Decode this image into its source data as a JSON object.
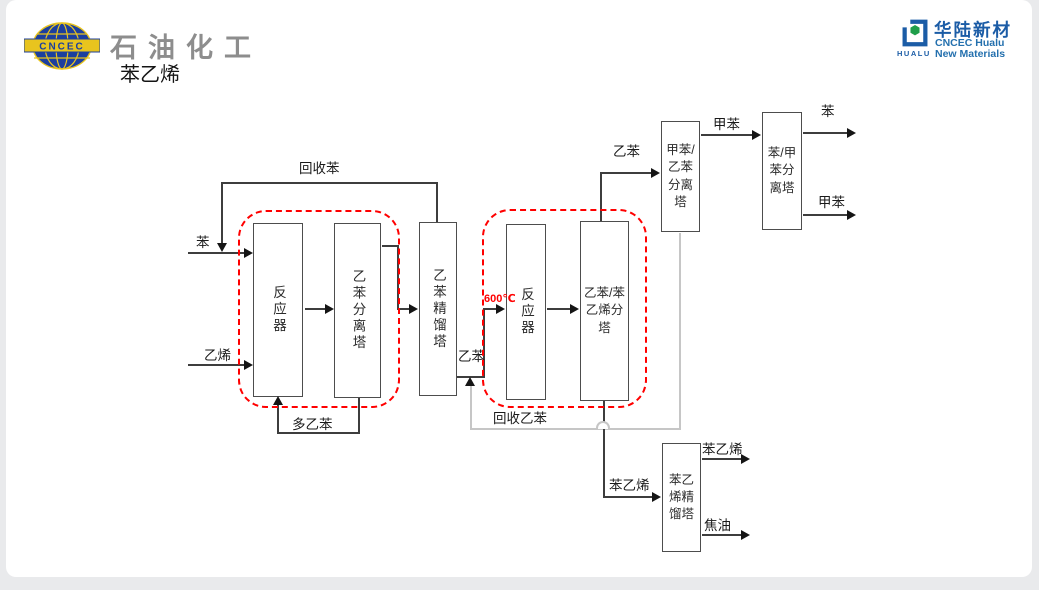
{
  "slide": {
    "brand_left": {
      "logo_text": "CNCEC",
      "dept_title": "石油化工",
      "slide_title": "苯乙烯"
    },
    "brand_right": {
      "cn_name": "华陆新材",
      "en_line1": "CNCEC Hualu",
      "en_line2": "New Materials",
      "icon_word": "HUALU"
    }
  },
  "diagram": {
    "towers": [
      {
        "id": "reactor-1",
        "label": "反应器"
      },
      {
        "id": "ethylbenzene-separation-tower",
        "label": "乙苯分离塔"
      },
      {
        "id": "ethylbenzene-distillation-tower",
        "label": "乙苯精馏塔"
      },
      {
        "id": "reactor-2",
        "label": "反应器"
      },
      {
        "id": "eb-styrene-separation-tower",
        "label": "乙苯/苯乙烯分塔",
        "lines": [
          "乙苯/苯",
          "乙烯分",
          "塔"
        ]
      },
      {
        "id": "toluene-eb-separation-tower",
        "label": "甲苯/乙苯分离塔",
        "lines": [
          "甲苯/",
          "乙苯",
          "分离",
          "塔"
        ]
      },
      {
        "id": "benzene-toluene-separation-tower",
        "label": "苯/甲苯分离塔",
        "lines": [
          "苯/甲",
          "苯分",
          "离塔"
        ]
      },
      {
        "id": "styrene-distillation-tower",
        "label": "苯乙烯精馏塔",
        "lines": [
          "苯乙",
          "烯精",
          "馏塔"
        ]
      }
    ],
    "stream_labels": {
      "benzene_feed": "苯",
      "ethylene_feed": "乙烯",
      "recycle_benzene": "回收苯",
      "poly_ethylbenzene": "多乙苯",
      "ethylbenzene_mid": "乙苯",
      "reactor2_temp": "600℃",
      "ethylbenzene_top": "乙苯",
      "toluene_mid": "甲苯",
      "benzene_out": "苯",
      "toluene_out": "甲苯",
      "recycle_ethylbenzene": "回收乙苯",
      "styrene_mid": "苯乙烯",
      "styrene_out": "苯乙烯",
      "tar_out": "焦油"
    },
    "colors": {
      "process_line": "#3d3d3d",
      "recycle_line": "#c6c6c6",
      "highlight_dashed_box": "#ff0000",
      "temperature_text": "#ff0000",
      "brand_blue": "#1b5ca6",
      "brand_green": "#1f9e4a",
      "logo_navy": "#1c3f9e",
      "logo_yellow": "#e8c41e"
    }
  }
}
